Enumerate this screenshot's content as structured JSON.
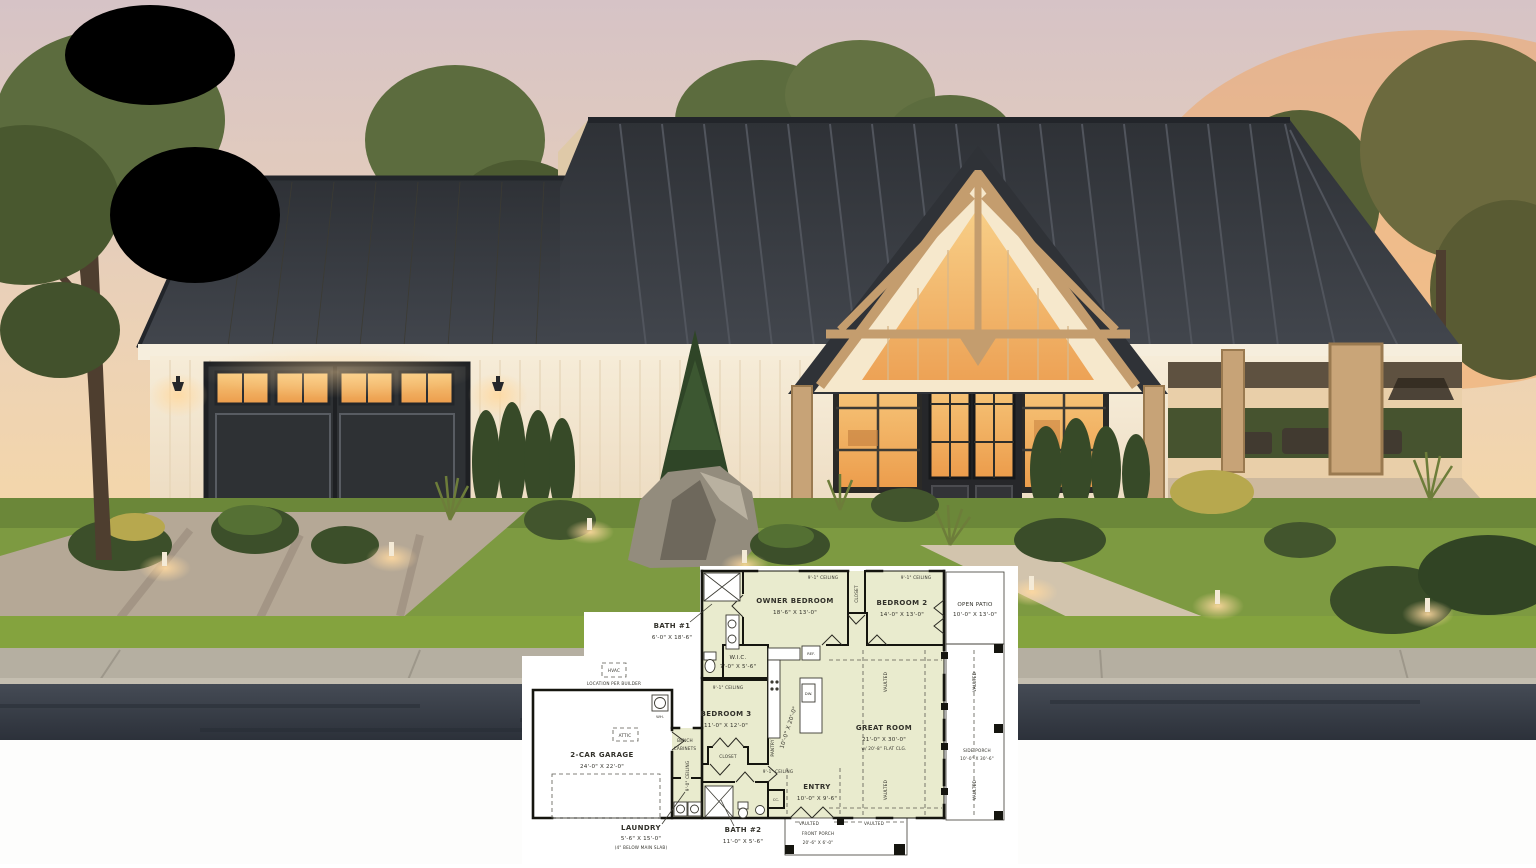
{
  "floorplan": {
    "rooms": {
      "bath1": {
        "name": "BATH #1",
        "dims": "6'-0\" X 18'-6\""
      },
      "owner": {
        "name": "OWNER BEDROOM",
        "dims": "18'-6\" X 13'-0\""
      },
      "bedroom2": {
        "name": "BEDROOM 2",
        "dims": "14'-0\" X 13'-0\""
      },
      "patio": {
        "name": "OPEN PATIO",
        "dims": "10'-0\" X 13'-0\""
      },
      "wic": {
        "name": "W.I.C.",
        "dims": "7'-0\" X 5'-6\""
      },
      "bedroom3": {
        "name": "BEDROOM 3",
        "dims": "11'-0\" X 12'-0\""
      },
      "kitchen": {
        "dims": "10'-0\" X 20'-0\""
      },
      "great": {
        "name": "GREAT ROOM",
        "dims": "21'-0\" X 30'-0\"",
        "note": "w/ 20'-8\" FLAT CLG."
      },
      "side_porch": {
        "name": "SIDE PORCH",
        "dims": "10'-0\" X 30'-6\""
      },
      "entry": {
        "name": "ENTRY",
        "dims": "10'-0\" X 9'-6\""
      },
      "garage": {
        "name": "2-CAR GARAGE",
        "dims": "24'-0\" X 22'-0\""
      },
      "laundry": {
        "name": "LAUNDRY",
        "dims": "5'-6\" X 15'-0\"",
        "note": "(4\" BELOW MAIN SLAB)"
      },
      "bath2": {
        "name": "BATH #2",
        "dims": "11'-0\" X 5'-6\""
      },
      "front_porch": {
        "line1": "VAULTED",
        "line2": "FRONT PORCH",
        "dims": "20'-6\" X 6'-0\""
      }
    },
    "labels": {
      "ceiling91": "9'-1\" CEILING",
      "ceiling90": "9'-0\" CEILING",
      "closet": "CLOSET",
      "pantry": "PANTRY",
      "ref": "REF.",
      "dw": "DW.",
      "wh": "WH.",
      "cc": "CC.",
      "attic": "ATTIC",
      "hvac": "HVAC",
      "hvac_note": "LOCATION PER BUILDER",
      "bench": "BENCH",
      "cabinets": "CABINETS",
      "vaulted": "VAULTED"
    },
    "colors": {
      "room_fill": "#e9ebce",
      "porch_fill": "#cfe9f1",
      "wall": "#15150f",
      "backdrop": "#ffffff"
    }
  },
  "scene_colors": {
    "sky_top": "#d6c3c6",
    "sky_horizon": "#f7d8a6",
    "sunset_glow": "#f2a35e",
    "roof": "#33363b",
    "siding": "#f4e7d0",
    "timber": "#c49d6e",
    "window_glow": "#f2ae5e",
    "lawn": "#7d9a41",
    "road": "#343a43"
  }
}
